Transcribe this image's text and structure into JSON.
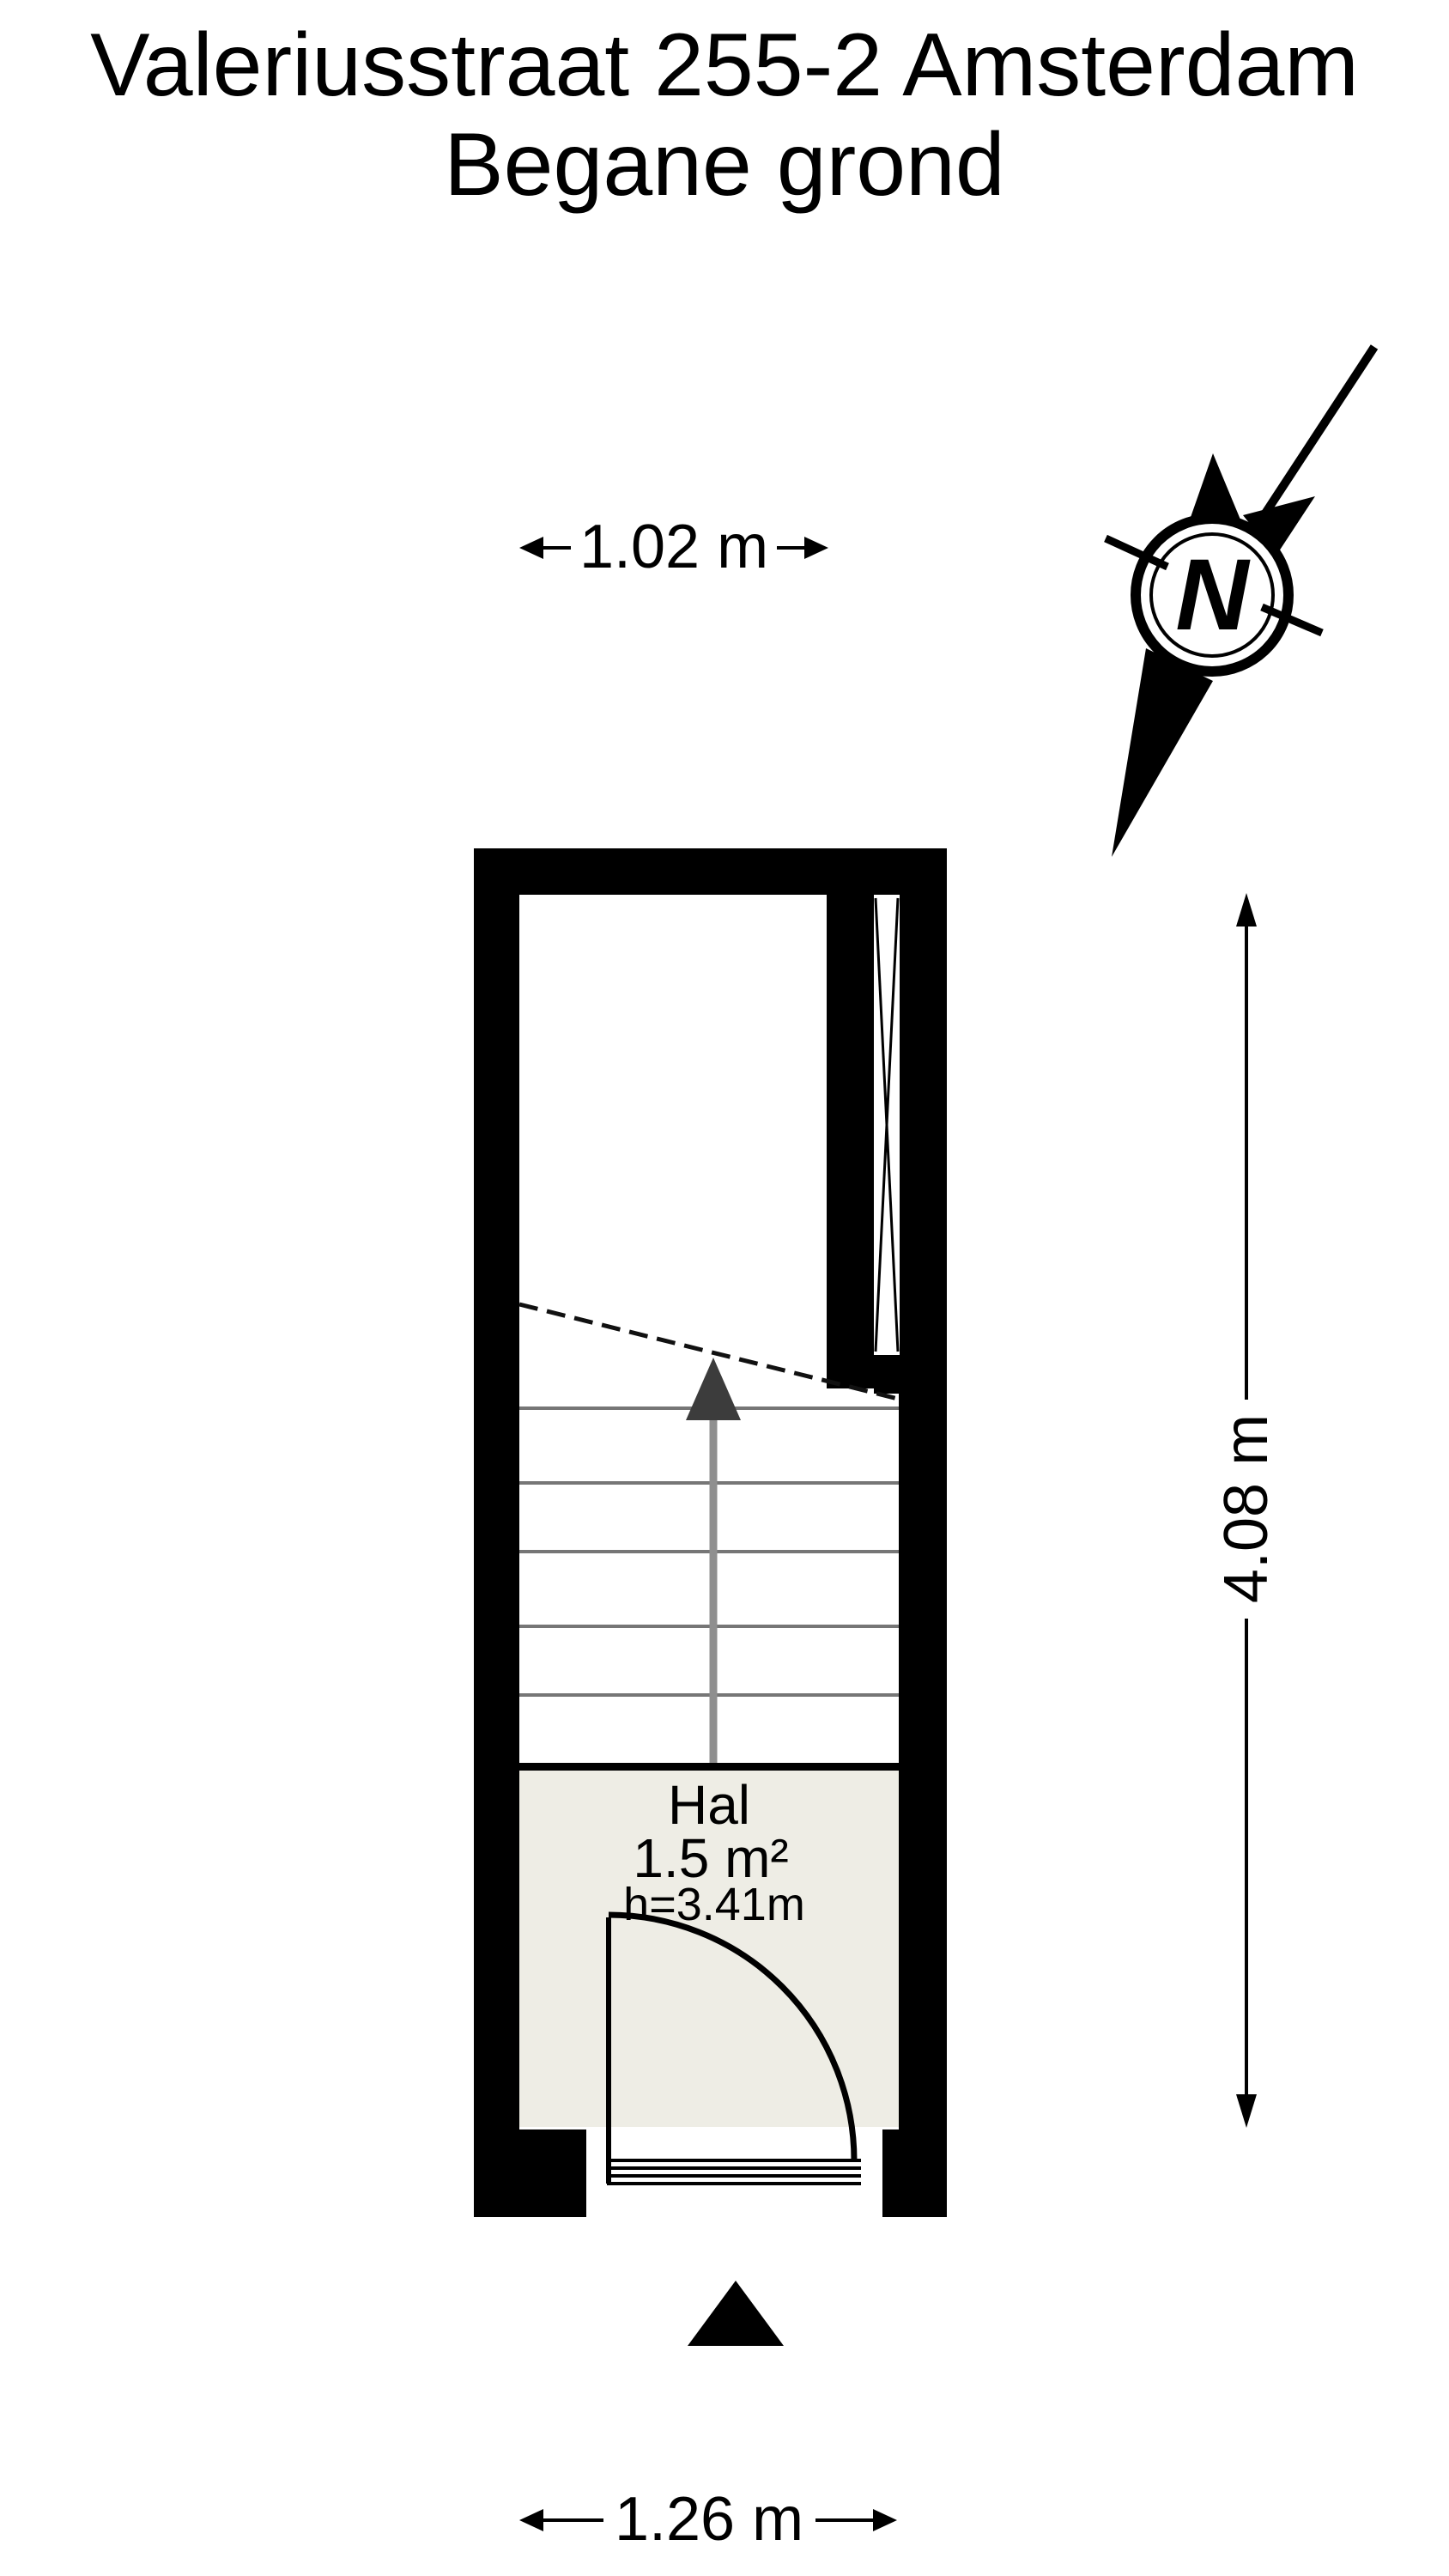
{
  "title": {
    "line1": "Valeriusstraat 255-2 Amsterdam",
    "line2": "Begane grond"
  },
  "compass": {
    "label": "N"
  },
  "dimensions": {
    "top": "1.02 m",
    "right": "4.08 m",
    "bottom": "1.26 m"
  },
  "room": {
    "name": "Hal",
    "area": "1.5 m²",
    "ceiling_height": "h=3.41m"
  },
  "colors": {
    "background": "#ffffff",
    "wall": "#000000",
    "room_fill": "#eeede5",
    "stair_tread": "#767676",
    "stair_arrow_shaft": "#8f8f8f",
    "stair_arrow_head": "#3c3c3c",
    "text": "#000000"
  }
}
